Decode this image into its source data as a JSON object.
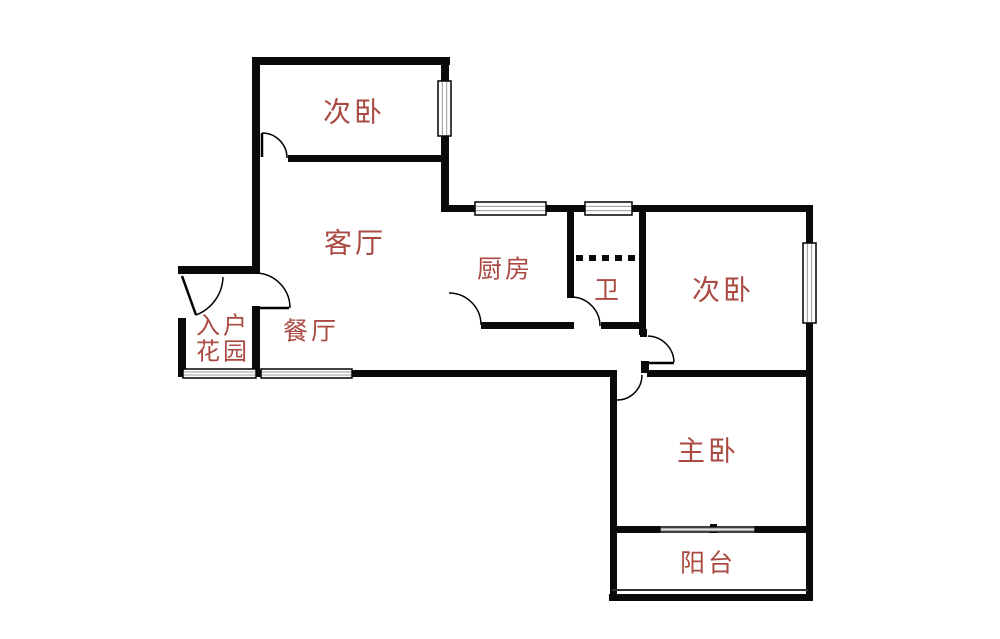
{
  "canvas": {
    "width": 1000,
    "height": 639,
    "background": "#ffffff"
  },
  "style": {
    "wall_color": "#0a0a0a",
    "label_color": "#aa4a42",
    "window_fill": "#ffffff",
    "window_border": "#000000",
    "window_pane_line": "#999999",
    "door_line": "#000000",
    "railing_color": "#333333"
  },
  "rooms": [
    {
      "id": "bedroom-top",
      "label": "次卧"
    },
    {
      "id": "living-room",
      "label": "客厅"
    },
    {
      "id": "kitchen",
      "label": "厨房"
    },
    {
      "id": "bathroom",
      "label": "卫"
    },
    {
      "id": "bedroom-right",
      "label": "次卧"
    },
    {
      "id": "entry-garden",
      "label": "入户\n花园"
    },
    {
      "id": "dining-room",
      "label": "餐厅"
    },
    {
      "id": "master-bedroom",
      "label": "主卧"
    },
    {
      "id": "balcony",
      "label": "阳台"
    }
  ],
  "walls": [
    [
      252,
      57,
      198,
      8
    ],
    [
      252,
      57,
      8,
      217
    ],
    [
      441,
      57,
      8,
      155
    ],
    [
      288,
      155,
      160,
      7
    ],
    [
      441,
      205,
      372,
      7
    ],
    [
      567,
      212,
      7,
      86
    ],
    [
      639,
      212,
      7,
      123
    ],
    [
      806,
      205,
      7,
      396
    ],
    [
      481,
      322,
      93,
      7
    ],
    [
      601,
      322,
      45,
      7
    ],
    [
      640,
      329,
      7,
      8
    ],
    [
      641,
      361,
      8,
      12
    ],
    [
      647,
      370,
      166,
      7
    ],
    [
      180,
      370,
      437,
      7
    ],
    [
      610,
      370,
      7,
      231
    ],
    [
      178,
      266,
      78,
      8
    ],
    [
      178,
      318,
      8,
      59
    ],
    [
      252,
      306,
      8,
      71
    ],
    [
      610,
      526,
      50,
      7
    ],
    [
      755,
      526,
      58,
      7
    ],
    [
      710,
      524,
      7,
      9
    ],
    [
      609,
      594,
      204,
      7
    ]
  ],
  "windows": [
    {
      "x": 438,
      "y": 81,
      "w": 13,
      "h": 55,
      "orient": "v"
    },
    {
      "x": 475,
      "y": 202,
      "w": 71,
      "h": 13,
      "orient": "h"
    },
    {
      "x": 585,
      "y": 202,
      "w": 47,
      "h": 13,
      "orient": "h"
    },
    {
      "x": 803,
      "y": 243,
      "w": 13,
      "h": 80,
      "orient": "v"
    },
    {
      "x": 183,
      "y": 369,
      "w": 73,
      "h": 9,
      "orient": "h"
    },
    {
      "x": 261,
      "y": 369,
      "w": 91,
      "h": 9,
      "orient": "h"
    },
    {
      "x": 660,
      "y": 527,
      "w": 95,
      "h": 5,
      "orient": "h"
    }
  ],
  "doors": [
    {
      "id": "bedroom-top-door",
      "arc": "M262,133 A25,25 0 0 1 287,158",
      "leaf": [
        262,
        133,
        262,
        157
      ]
    },
    {
      "id": "entry-garden-door",
      "arc": "M223,277 A42,42 0 0 1 196,315",
      "leaf": [
        182,
        276,
        196,
        315
      ]
    },
    {
      "id": "living-entry-door",
      "arc": "M256,273 A35,35 0 0 1 290,308",
      "leaf": [
        255,
        308,
        289,
        308
      ]
    },
    {
      "id": "kitchen-door",
      "arc": "M449,293 A32,32 0 0 1 481,325",
      "leaf": null
    },
    {
      "id": "bathroom-door",
      "arc": "M571,297 A29,29 0 0 1 600,326",
      "leaf": null
    },
    {
      "id": "bedroom-right-door",
      "arc": "M648,336 A27,27 0 0 1 674,362",
      "leaf": [
        647,
        363,
        674,
        363
      ]
    },
    {
      "id": "master-door",
      "arc": "M642,375 A25,25 0 0 1 617,400",
      "leaf": null
    }
  ],
  "dashed_partition": {
    "x1": 576,
    "y1": 258,
    "x2": 638,
    "y2": 258
  },
  "thin_lines": [
    [
      612,
      590,
      808,
      590
    ]
  ]
}
